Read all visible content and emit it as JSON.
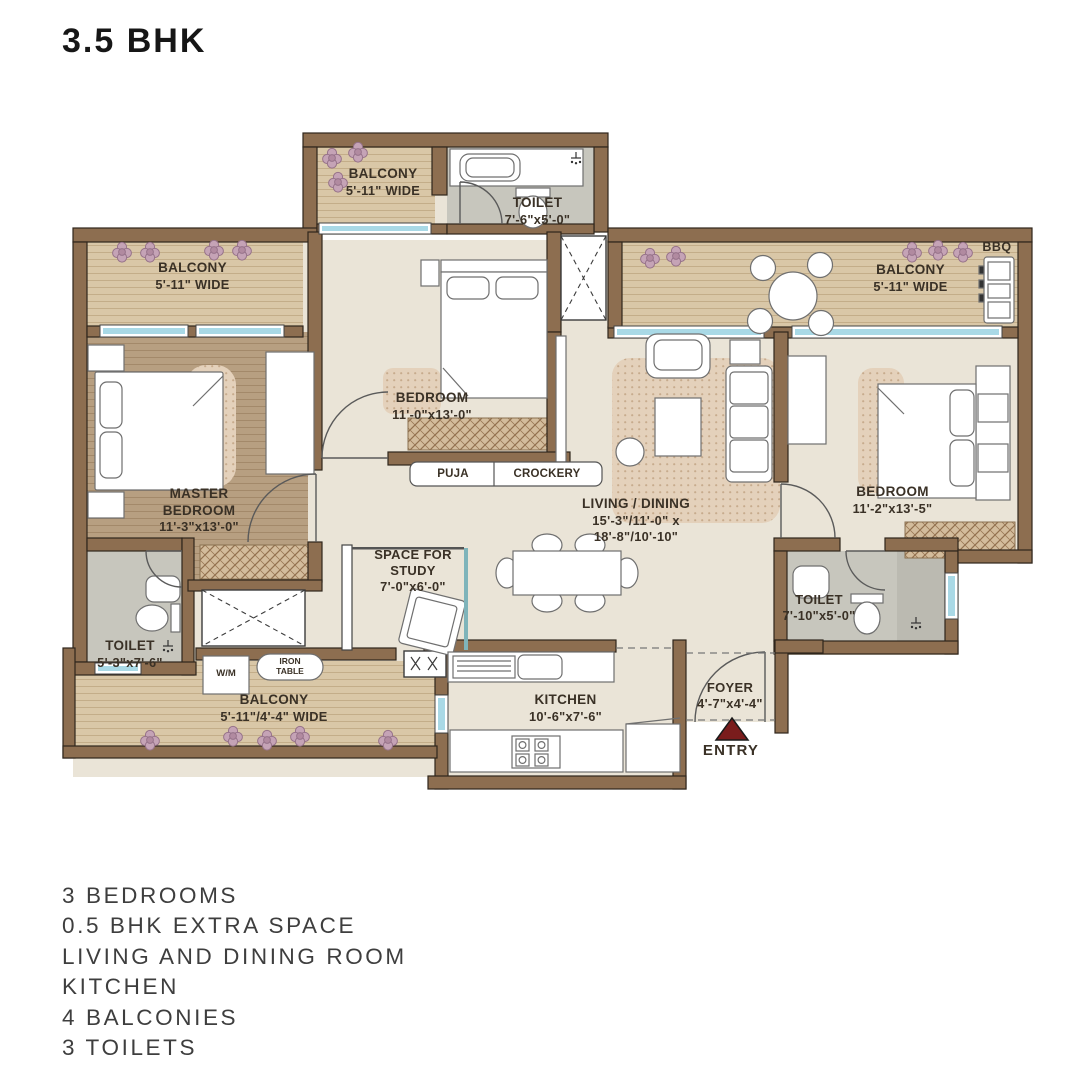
{
  "title": "3.5 BHK",
  "plan": {
    "balcony_top": {
      "name": "BALCONY",
      "dims": "5'-11\" WIDE"
    },
    "toilet_top": {
      "name": "TOILET",
      "dims": "7'-6\"x5'-0\""
    },
    "balcony_left": {
      "name": "BALCONY",
      "dims": "5'-11\" WIDE"
    },
    "balcony_right": {
      "name": "BALCONY",
      "dims": "5'-11\" WIDE"
    },
    "bbq": "BBQ",
    "master_bedroom": {
      "line1": "MASTER",
      "line2": "BEDROOM",
      "dims": "11'-3\"x13'-0\""
    },
    "bedroom_mid": {
      "name": "BEDROOM",
      "dims": "11'-0\"x13'-0\""
    },
    "bedroom_right": {
      "name": "BEDROOM",
      "dims": "11'-2\"x13'-5\""
    },
    "living_dining": {
      "name": "LIVING / DINING",
      "dims1": "15'-3\"/11'-0\" x",
      "dims2": "18'-8\"/10'-10\""
    },
    "puja": "PUJA",
    "crockery": "CROCKERY",
    "study": {
      "line1": "SPACE FOR",
      "line2": "STUDY",
      "dims": "7'-0\"x6'-0\""
    },
    "toilet_left": {
      "name": "TOILET",
      "dims": "5'-3\"x7'-6\""
    },
    "toilet_right": {
      "name": "TOILET",
      "dims": "7'-10\"x5'-0\""
    },
    "wm": "W/M",
    "iron_line1": "IRON",
    "iron_line2": "TABLE",
    "balcony_bottom": {
      "name": "BALCONY",
      "dims": "5'-11\"/4'-4\" WIDE"
    },
    "kitchen": {
      "name": "KITCHEN",
      "dims": "10'-6\"x7'-6\""
    },
    "foyer": {
      "name": "FOYER",
      "dims": "4'-7\"x4'-4\""
    },
    "entry": "ENTRY"
  },
  "features": [
    "3 BEDROOMS",
    "0.5 BHK EXTRA SPACE",
    "LIVING AND DINING ROOM",
    "KITCHEN",
    "4 BALCONIES",
    "3 TOILETS"
  ],
  "colors": {
    "wall": "#8d6e50",
    "wood": "#d9c7a7",
    "wood_dark": "#b79f81",
    "floor": "#eae4d7",
    "toilet": "#c7c6bd",
    "window": "#a9d9e6",
    "entry_arrow": "#7a1c1c",
    "flower": "#c5a3b6"
  }
}
